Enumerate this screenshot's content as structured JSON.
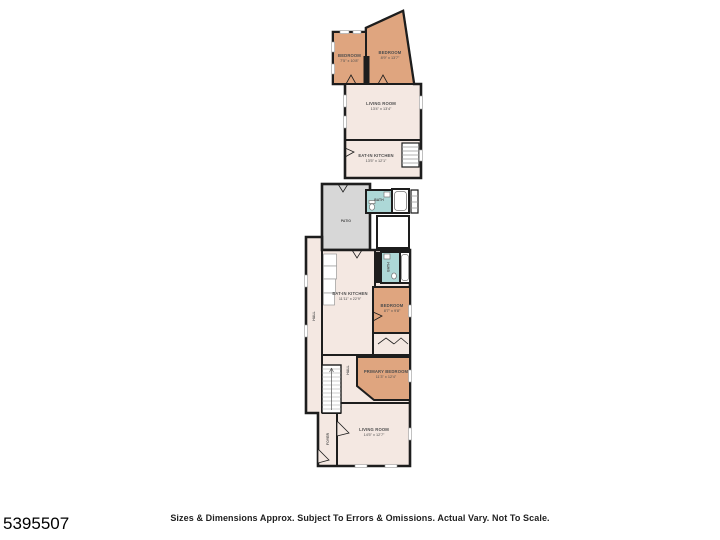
{
  "page": {
    "listing_id": "5395507",
    "disclaimer": "Sizes & Dimensions Approx. Subject To Errors & Omissions. Actual Vary. Not To Scale."
  },
  "colors": {
    "bedroom_fill": "#dfa57f",
    "room_fill": "#f4e8e2",
    "patio_fill": "#d7d7d7",
    "bath_fill": "#add8d7",
    "wall": "#1d1d1d",
    "background": "#ffffff"
  },
  "floorplan": {
    "rooms": [
      {
        "name": "BEDROOM",
        "dims": "7'5\" x 10'8\""
      },
      {
        "name": "BEDROOM",
        "dims": "8'9\" x 13'7\""
      },
      {
        "name": "LIVING ROOM",
        "dims": "13'4\" x 13'4\""
      },
      {
        "name": "EAT-IN KITCHEN",
        "dims": "13'5\" x 12'1\""
      },
      {
        "name": "PATIO",
        "dims": ""
      },
      {
        "name": "BATH",
        "dims": ""
      },
      {
        "name": "HALL",
        "dims": ""
      },
      {
        "name": "EAT-IN KITCHEN",
        "dims": "11'11\" x 22'9\""
      },
      {
        "name": "BATH",
        "dims": ""
      },
      {
        "name": "BEDROOM",
        "dims": "8'7\" x 9'8\""
      },
      {
        "name": "PRIMARY BEDROOM",
        "dims": "11'3\" x 12'4\""
      },
      {
        "name": "HALL",
        "dims": ""
      },
      {
        "name": "LIVING ROOM",
        "dims": "14'5\" x 12'7\""
      },
      {
        "name": "FOYER",
        "dims": ""
      }
    ]
  }
}
